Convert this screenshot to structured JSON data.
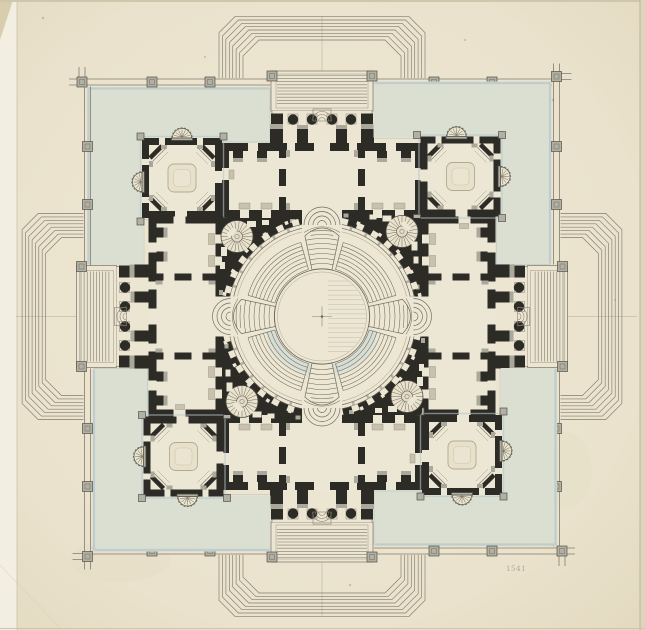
{
  "artwork": {
    "title": "Symmetrical neoclassical floor plan with central circular rotunda",
    "medium": "pen, ink and wash drawing on aged paper",
    "symmetry": "four-fold about central rotunda"
  },
  "inscription": {
    "text": "1541"
  },
  "features": {
    "rotunda": "central circular hall with concentric stepped ring and four stair flights",
    "corner_pavilions": 4,
    "porticos": 4,
    "spiral_staircases": 4,
    "shell_niches": 8,
    "courtyards": "four L-shaped blue-washed terraces inside posted border",
    "outer_steps": "chamfered stepped bands projecting around each portico"
  },
  "palette": {
    "paper": "#eae2cc",
    "paper_light": "#f2eee1",
    "paper_edge": "#d8ceae",
    "court_wash": "#dadfd2",
    "ink": "#2d2b26",
    "line": "#837c6c",
    "pier_gray": "#b1b0a2",
    "door_gray": "#c7c2ae",
    "blue_shadow": "#b5c7ca",
    "step_tint": "#cfd9d4",
    "stain": "#b09f7e"
  }
}
